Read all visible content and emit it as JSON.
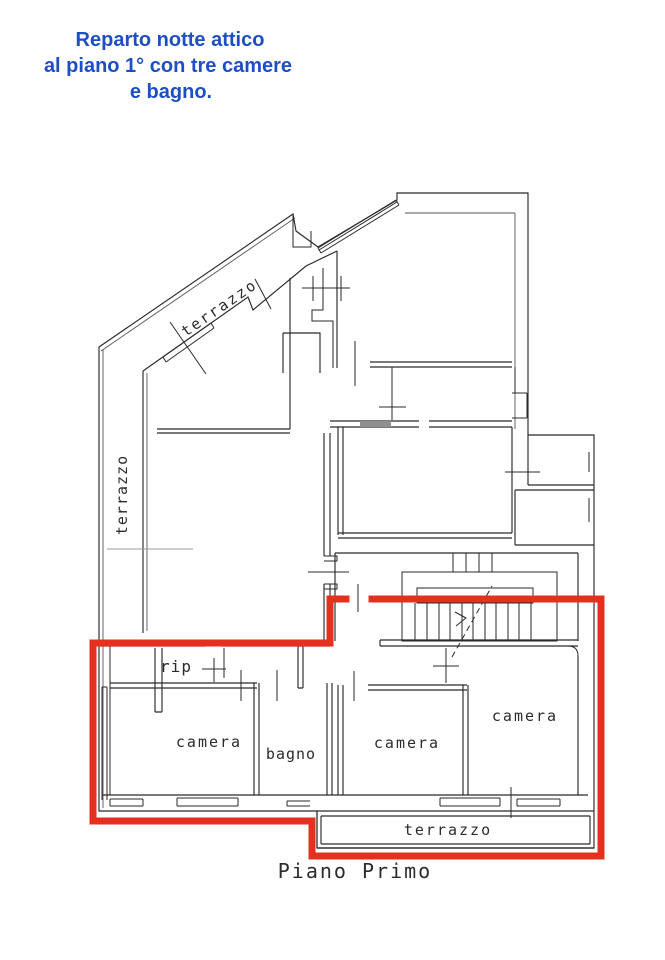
{
  "title": {
    "line1": "Reparto notte attico",
    "line2": "al piano 1° con tre camere",
    "line3": "e bagno."
  },
  "labels": {
    "terrace_top": "terrazzo",
    "terrace_left": "terrazzo",
    "storage": "rip",
    "bedroom_left": "camera",
    "bathroom": "bagno",
    "bedroom_center": "camera",
    "bedroom_right": "camera",
    "terrace_bottom": "terrazzo"
  },
  "caption": "Piano Primo",
  "colors": {
    "title_blue": "#1e4fc2",
    "highlight_red": "#e53020",
    "wall": "#2a2a2a"
  }
}
